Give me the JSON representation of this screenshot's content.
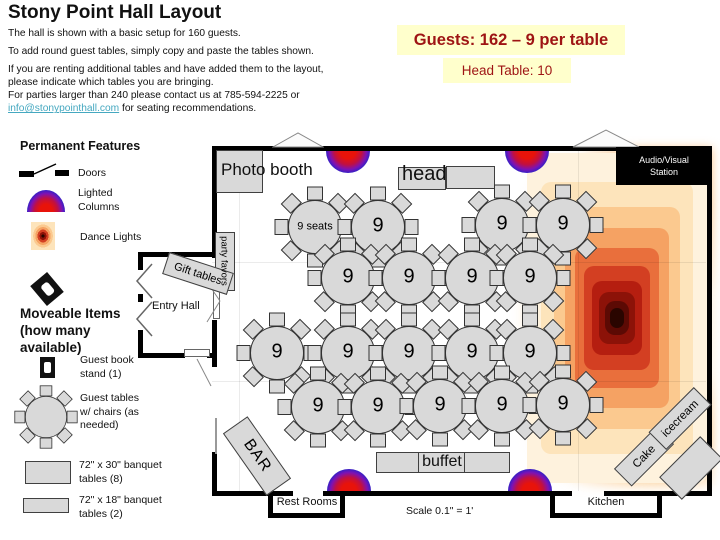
{
  "slide": {
    "title": "Stony Point Hall Layout",
    "intro_1": "The hall is shown with a basic setup for 160 guests.",
    "intro_2": "To add round guest tables, simply copy and paste the tables shown.",
    "intro_3": "If you are renting additional tables and have added them to the layout, please indicate which tables you are bringing.",
    "intro_4_pre": "For parties larger than 240 please contact us at 785-594-2225 or ",
    "intro_4_link": "info@stonypointhall.com",
    "intro_4_post": " for seating recommendations."
  },
  "notes": {
    "guests": "Guests: 162 – 9 per table",
    "head_table": "Head Table: 10"
  },
  "legend": {
    "permanent_title": "Permanent Features",
    "doors_label": "Doors",
    "lighted_columns_label": "Lighted Columns",
    "dance_lights_label": "Dance Lights",
    "moveable_title_line1": "Moveable Items",
    "moveable_title_line2": "(how many",
    "moveable_title_line3": "available)",
    "guest_book_label": "Guest book stand (1)",
    "guest_tables_label": "Guest tables w/ chairs (as needed)",
    "banquet_30_label": "72\" x 30\" banquet tables (8)",
    "banquet_18_label": "72\" x 18\" banquet tables (2)"
  },
  "map": {
    "photo_booth": "Photo booth",
    "head_label": "head",
    "av_station": "Audio/Visual Station",
    "party_favors": "party favors",
    "gift_tables": "Gift tables",
    "entry_hall": "Entry Hall",
    "bar": "BAR",
    "buffet": "buffet",
    "rest_rooms": "Rest Rooms",
    "kitchen": "Kitchen",
    "cake": "Cake",
    "icecream": "icecream",
    "scale_note": "Scale 0.1\" = 1'",
    "tables": {
      "seats_per_table": 9,
      "count": 18,
      "first_table_label": "9 seats",
      "table_label": "9",
      "positions": [
        [
          315,
          227
        ],
        [
          378,
          227
        ],
        [
          502,
          225
        ],
        [
          563,
          225
        ],
        [
          348,
          278
        ],
        [
          409,
          278
        ],
        [
          472,
          278
        ],
        [
          530,
          278
        ],
        [
          277,
          353
        ],
        [
          348,
          353
        ],
        [
          409,
          353
        ],
        [
          472,
          353
        ],
        [
          530,
          353
        ],
        [
          318,
          407
        ],
        [
          378,
          407
        ],
        [
          440,
          406
        ],
        [
          502,
          406
        ],
        [
          563,
          405
        ]
      ]
    },
    "lighted_columns": [
      [
        348,
        "down"
      ],
      [
        527,
        "down"
      ],
      [
        349,
        "up"
      ],
      [
        530,
        "up"
      ]
    ]
  },
  "colors": {
    "note_bg": "#ffffcc",
    "note_text": "#9e1414",
    "link": "#45a8c0",
    "table_fill": "#d9d9d9",
    "wall": "#000000"
  }
}
